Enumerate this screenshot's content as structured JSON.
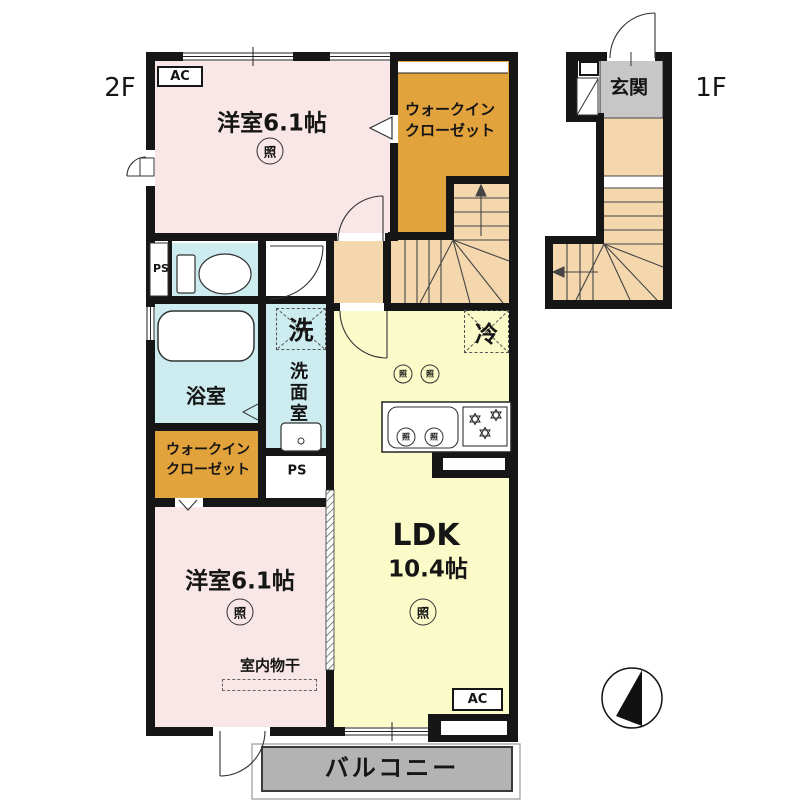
{
  "labels": {
    "floor_2f": "2F",
    "floor_1f": "1F",
    "ac": "AC",
    "ps": "PS",
    "light": "照",
    "laundry": "洗",
    "fridge": "冷"
  },
  "rooms": {
    "bedroom_top": "洋室6.1帖",
    "bedroom_bottom": "洋室6.1帖",
    "wic_line1": "ウォークイン",
    "wic_line2": "クローゼット",
    "entrance": "玄関",
    "bath": "浴室",
    "washroom": "洗面室",
    "ldk_name": "LDK",
    "ldk_size": "10.4帖",
    "drying": "室内物干",
    "balcony": "バルコニー"
  },
  "colors": {
    "room_pink": "#f9e6e6",
    "closet_orange": "#e2a23c",
    "hall_peach": "#f5d7ae",
    "wet_blue": "#cdecf0",
    "ldk_yellow": "#fafbc9",
    "entrance_gray": "#c7c7c7",
    "balcony_gray": "#b3b3b3",
    "wall_black": "#161616"
  }
}
